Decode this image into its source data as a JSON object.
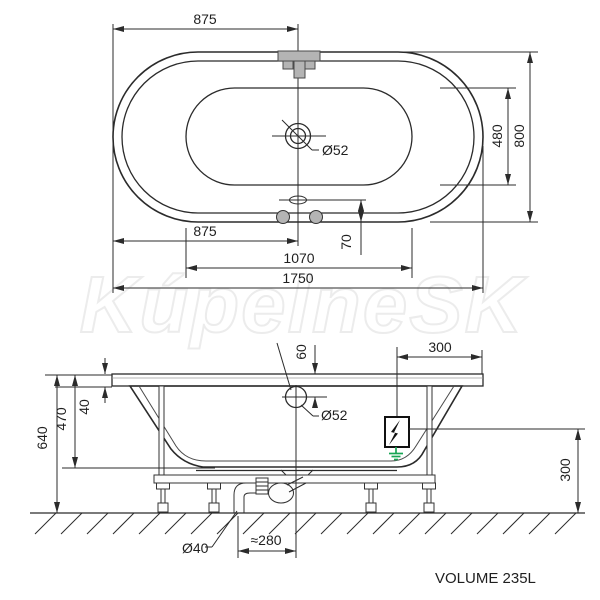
{
  "watermark": "KúpelneSK",
  "volume_label": "VOLUME 235L",
  "top_view": {
    "dim_top_875": "875",
    "dim_inner_width_480": "480",
    "dim_outer_width_800": "800",
    "dim_drain_diameter": "Ø52",
    "dim_bottom_875": "875",
    "dim_overflow_offset_70": "70",
    "dim_inner_length_1070": "1070",
    "dim_outer_length_1750": "1750"
  },
  "side_view": {
    "dim_overflow_depth_60": "60",
    "dim_overflow_diameter": "Ø52",
    "dim_top_300": "300",
    "dim_rim_40": "40",
    "dim_depth_470": "470",
    "dim_height_640": "640",
    "dim_right_300": "300",
    "dim_waste_diameter": "Ø40",
    "dim_waste_offset_280": "≈280"
  },
  "colors": {
    "line": "#2b2b2b",
    "tub_fill": "#ebebeb",
    "tub_stripe": "#e2e2e2",
    "fixture_gray": "#b4b4b4",
    "ground_green": "#17a554",
    "electric_black": "#111111"
  }
}
